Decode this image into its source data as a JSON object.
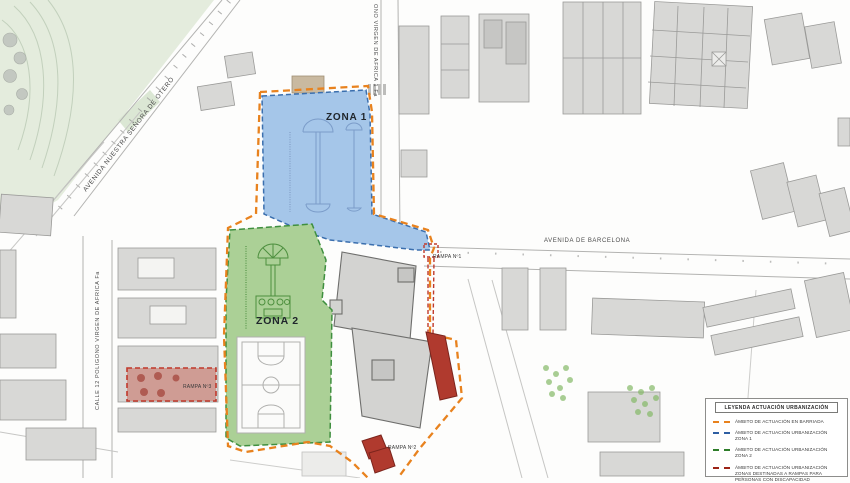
{
  "map": {
    "zone1": {
      "label": "ZONA 1",
      "fill": "#a5c6e9",
      "border": "#3b6fae"
    },
    "zone2": {
      "label": "ZONA 2",
      "fill": "#abd096",
      "border": "#3f8f3f"
    },
    "rampa1_label": "RAMPA Nº1",
    "rampa2_label": "RAMPA Nº2",
    "rampa3_label": "RAMPA Nº3",
    "streets": {
      "avenida_barcelona": "AVENIDA DE BARCELONA",
      "avenida_otero": "AVENIDA NUESTRA SEÑORA DE OTERO",
      "calle_poligono": "CALLE 12 POLIGONO VIRGEN DE AFRICA Fa",
      "calle_virgen_africa": "ONO VIRGEN DE AFRICA 1 Fa"
    },
    "boundary_color": "#e8821e",
    "rampa_color": "#b03a2e"
  },
  "legend": {
    "title": "LEYENDA ACTUACIÓN URBANIZACIÓN",
    "items": [
      {
        "label": "ÁMBITO DE ACTUACIÓN EN BARRIADA",
        "color": "#e8821e"
      },
      {
        "label": "ÁMBITO DE ACTUACIÓN URBANIZACIÓN ZONA 1",
        "color": "#2e5fa3"
      },
      {
        "label": "ÁMBITO DE ACTUACIÓN URBANIZACIÓN ZONA 2",
        "color": "#2e7d2a"
      },
      {
        "label": "ÁMBITO DE ACTUACIÓN URBANIZACIÓN ZONAS DESTINADAS A RAMPAS PARA PERSONAS CON DISCAPACIDAD",
        "color": "#9c2417"
      }
    ]
  }
}
